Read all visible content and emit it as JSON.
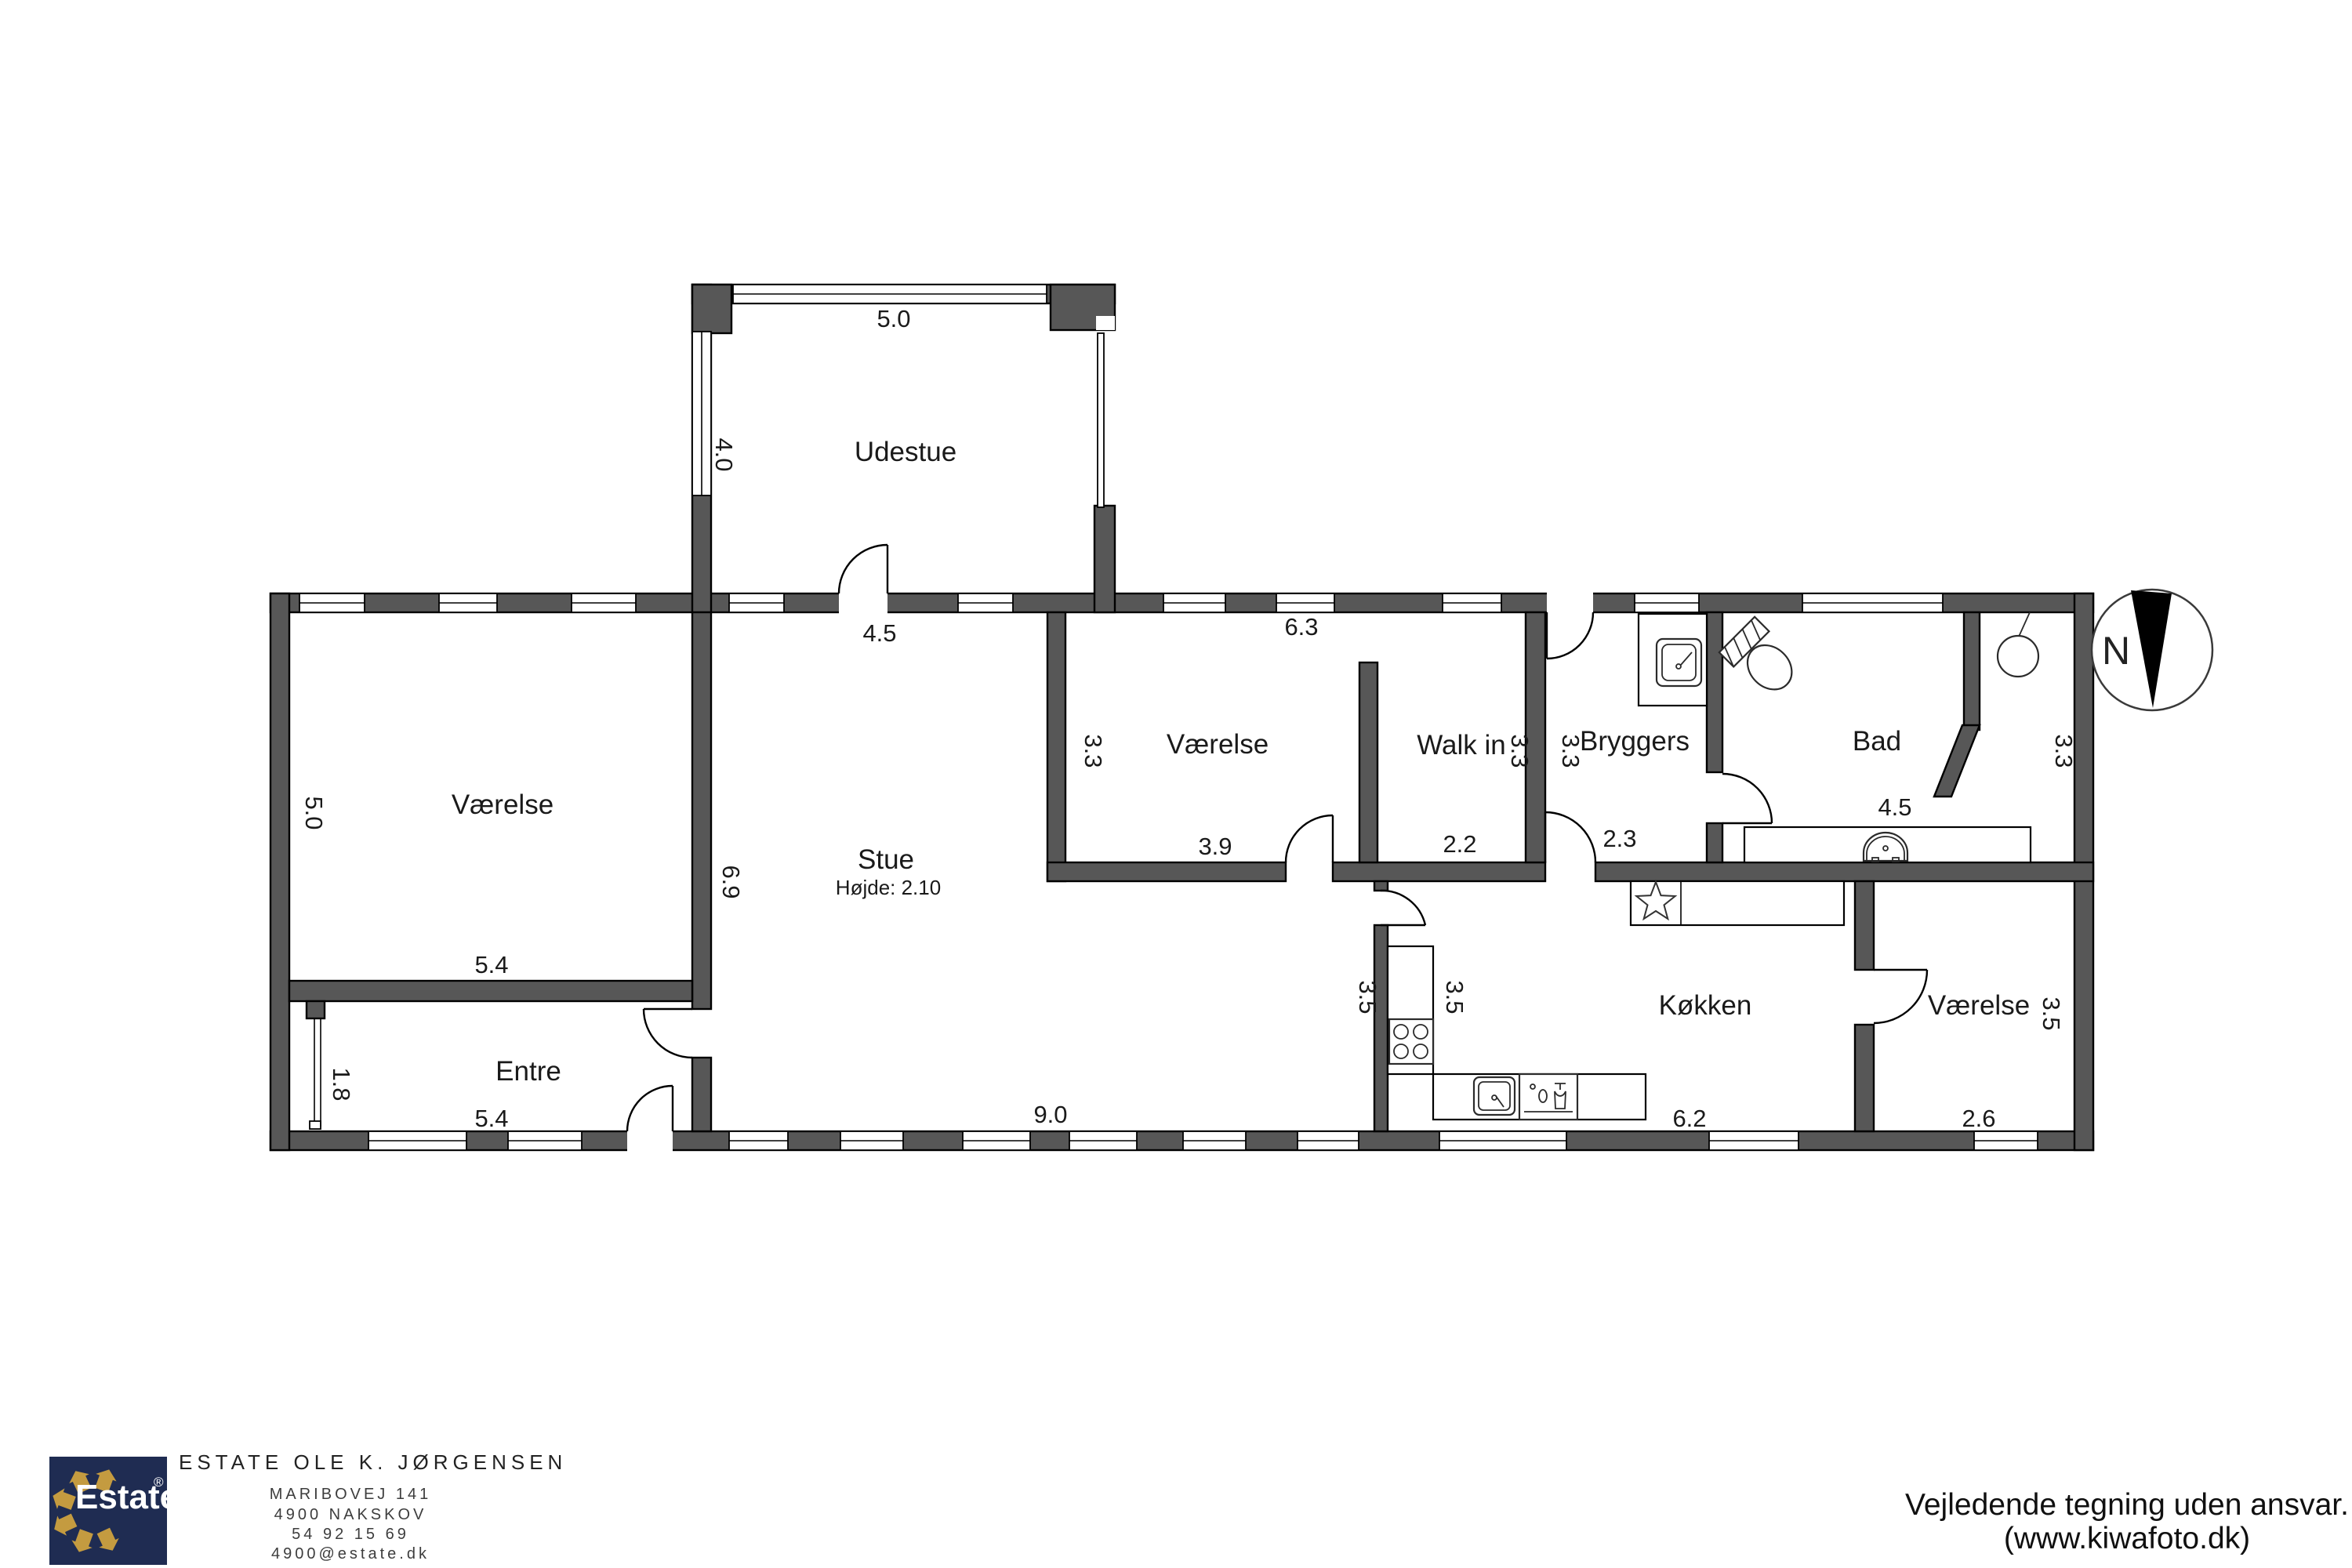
{
  "plan": {
    "title_hint": "floor-plan",
    "wall_color": "#575757",
    "rooms": [
      {
        "name": "Udestue",
        "width": "5.0",
        "depth": "4.0",
        "door": "4.5"
      },
      {
        "name": "Værelse",
        "width": "5.4",
        "depth": "5.0"
      },
      {
        "name": "Entre",
        "width": "5.4",
        "window": "1.8"
      },
      {
        "name": "Stue",
        "note": "Højde: 2.10",
        "width": "9.0",
        "depth": "6.9"
      },
      {
        "name": "Værelse",
        "width": "3.9",
        "top": "6.3",
        "depth": "3.3"
      },
      {
        "name": "Walk in",
        "width": "2.2",
        "depth": "3.3"
      },
      {
        "name": "Bryggers",
        "width": "2.3",
        "depth": "3.3"
      },
      {
        "name": "Bad",
        "width": "4.5",
        "depth": "3.3"
      },
      {
        "name": "Køkken",
        "width": "6.2",
        "depth": "3.5",
        "stue_side": "3.5"
      },
      {
        "name": "Værelse",
        "width": "2.6",
        "depth": "3.5"
      }
    ],
    "compass": {
      "north": "N"
    }
  },
  "branding": {
    "logo_text": "Estate",
    "registered": "®",
    "logo_bg": "#1f2c52",
    "logo_gold": "#c49b40",
    "company": "ESTATE OLE K. JØRGENSEN",
    "address_line1": "MARIBOVEJ 141",
    "address_line2": "4900 NAKSKOV",
    "phone": "54 92 15 69",
    "email": "4900@estate.dk"
  },
  "footer": {
    "disclaimer_line1": "Vejledende tegning uden ansvar.",
    "disclaimer_line2": "(www.kiwafoto.dk)"
  }
}
